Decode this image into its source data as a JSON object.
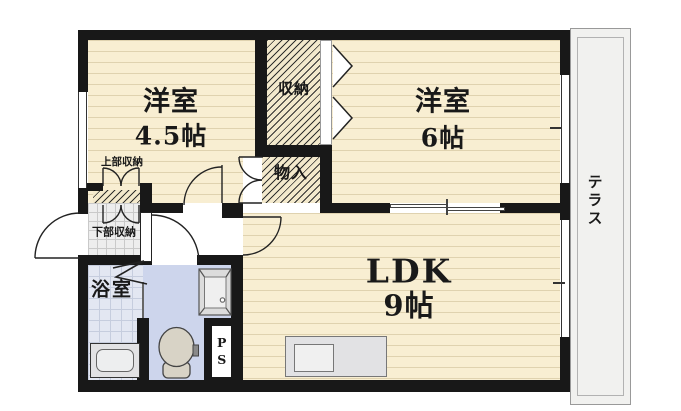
{
  "rooms": {
    "western_4_5": {
      "name": "洋室",
      "size": "4.5帖"
    },
    "western_6": {
      "name": "洋室",
      "size": "6帖"
    },
    "ldk": {
      "name": "LDK",
      "size": "9帖"
    },
    "bathroom": {
      "name": "浴室"
    },
    "terrace": {
      "name": "テラス"
    }
  },
  "storages": {
    "closet": {
      "name": "収納"
    },
    "mono_ire": {
      "name": "物入"
    },
    "upper_closet": {
      "name": "上部収納"
    },
    "lower_closet": {
      "name": "下部収納"
    },
    "pipe_space": {
      "name": "PS"
    }
  },
  "colors": {
    "floor": "#f8eed2",
    "wall": "#181818",
    "bath": "#e3e7f2",
    "toilet": "#cdd5ec",
    "terrace": "#f1f1ef",
    "fixture": "#e2e2e4"
  }
}
